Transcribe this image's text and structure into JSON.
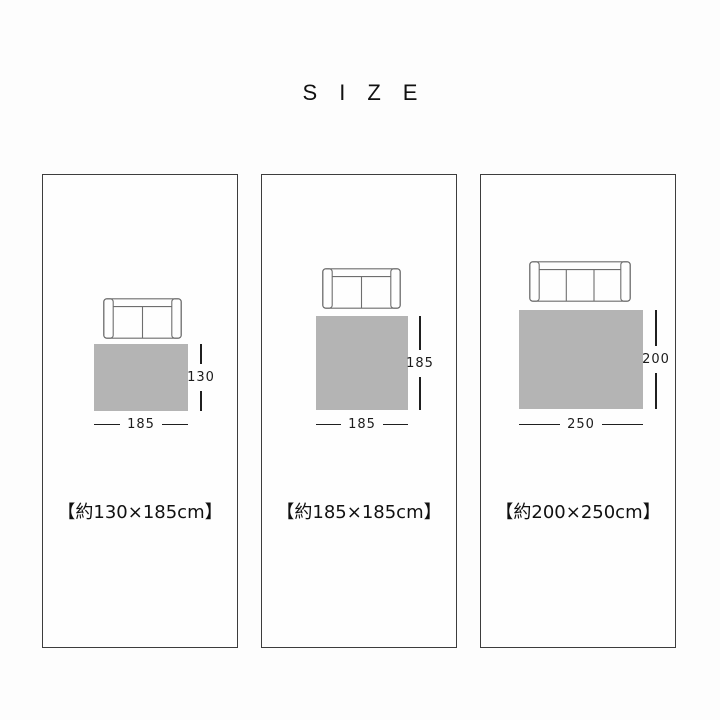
{
  "page": {
    "title": "SIZE"
  },
  "panels": [
    {
      "caption": "【約130×185cm】",
      "depth_label": "130",
      "width_label": "185",
      "sofa_seats": 2
    },
    {
      "caption": "【約185×185cm】",
      "depth_label": "185",
      "width_label": "185",
      "sofa_seats": 2
    },
    {
      "caption": "【約200×250cm】",
      "depth_label": "200",
      "width_label": "250",
      "sofa_seats": 3
    }
  ],
  "colors": {
    "page_background": "#fdfdfd",
    "panel_border": "#3d3d3d",
    "rug_fill": "#b4b4b4",
    "dimension_line": "#1f1f1f",
    "sofa_outline": "#6e6e6e",
    "text": "#111111"
  }
}
